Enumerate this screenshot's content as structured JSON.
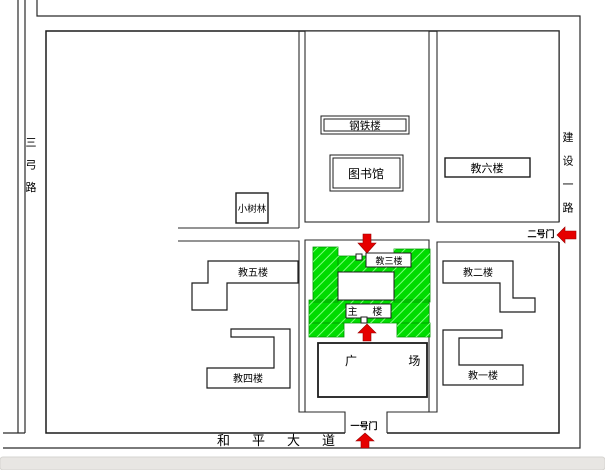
{
  "map": {
    "title": "campus plan drawing",
    "roads": {
      "left_vertical": "三弓路",
      "right_vertical": "建设一路",
      "bottom_horizontal": "和平大道"
    },
    "gates": {
      "gate1": "一号门",
      "gate2": "二号门"
    },
    "buildings": {
      "steel": "钢铁楼",
      "library": "图书馆",
      "teach6": "教六楼",
      "grove": "小树林",
      "teach5": "教五楼",
      "teach3": "教三楼",
      "teach2": "教二楼",
      "main": "主 楼",
      "teach4": "教四楼",
      "teach1": "教一楼",
      "plaza": "广 场"
    },
    "colors": {
      "building_green": "#00dc00",
      "hatch_green": "#7dff7d",
      "arrow_red": "#e60000",
      "line_dark": "#222222",
      "bottom_bar_gray": "#e8e6e3"
    }
  }
}
